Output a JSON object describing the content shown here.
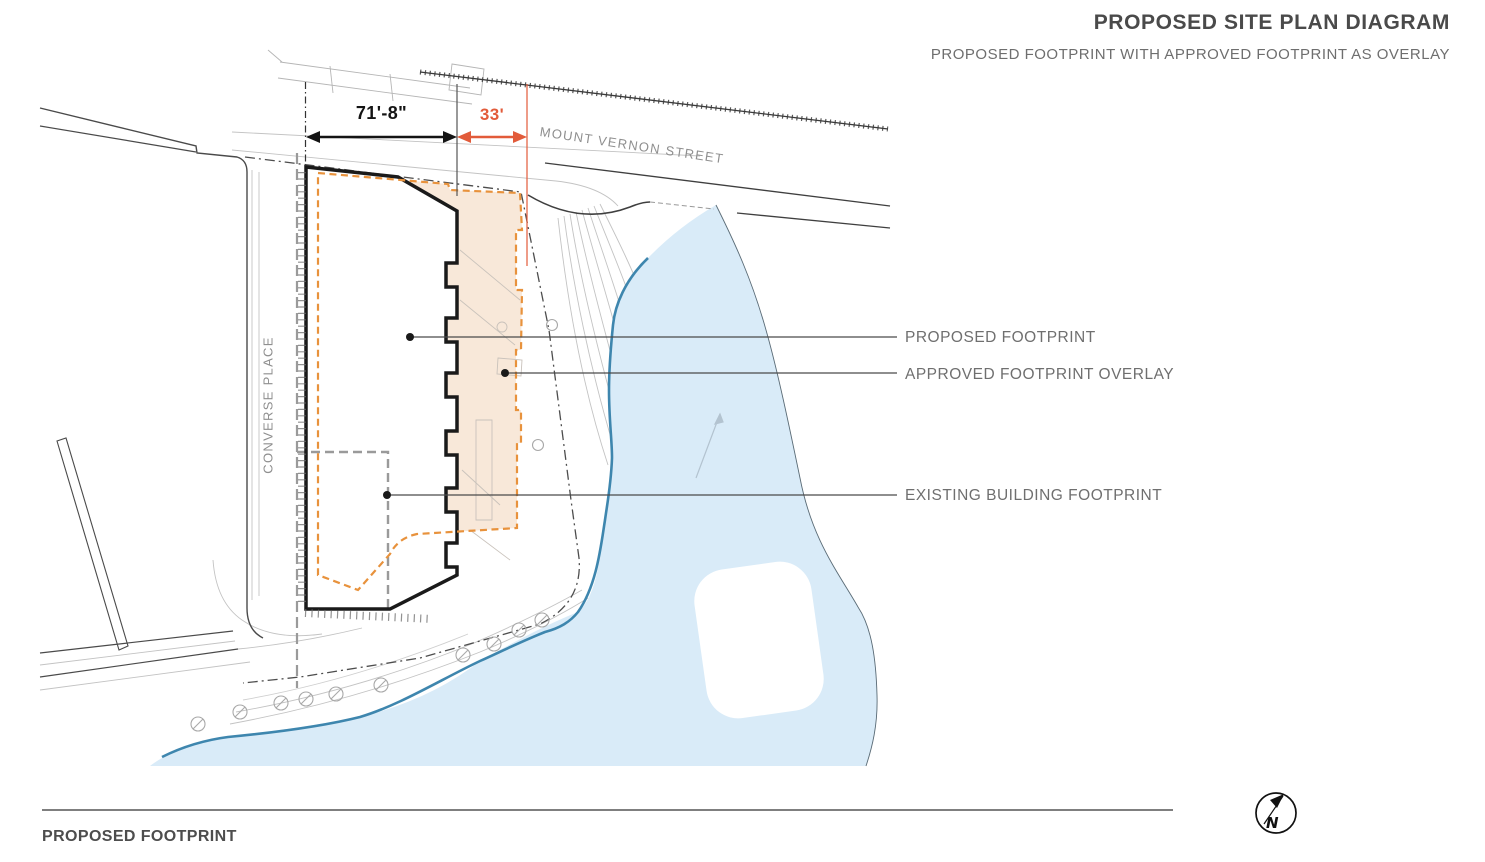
{
  "header": {
    "title": "PROPOSED SITE PLAN DIAGRAM",
    "subtitle": "PROPOSED FOOTPRINT WITH APPROVED FOOTPRINT AS OVERLAY"
  },
  "dimensions": {
    "proposed_width": "71'-8\"",
    "approved_extension": "33'"
  },
  "streets": {
    "mount_vernon": "MOUNT VERNON STREET",
    "converse": "CONVERSE PLACE"
  },
  "legend": {
    "proposed": "PROPOSED FOOTPRINT",
    "approved": "APPROVED FOOTPRINT OVERLAY",
    "existing": "EXISTING BUILDING FOOTPRINT"
  },
  "footer": {
    "caption": "PROPOSED FOOTPRINT"
  },
  "compass": {
    "label": "N"
  },
  "colors": {
    "proposed_outline": "#1a1a1a",
    "approved_outline": "#e8923c",
    "approved_fill": "#f8e8d9",
    "existing_outline": "#9a9a9a",
    "dimension_accent": "#e25b3a",
    "water_fill": "#d9ebf8",
    "water_edge": "#3e86ae",
    "label_gray": "#6f6f6f"
  }
}
